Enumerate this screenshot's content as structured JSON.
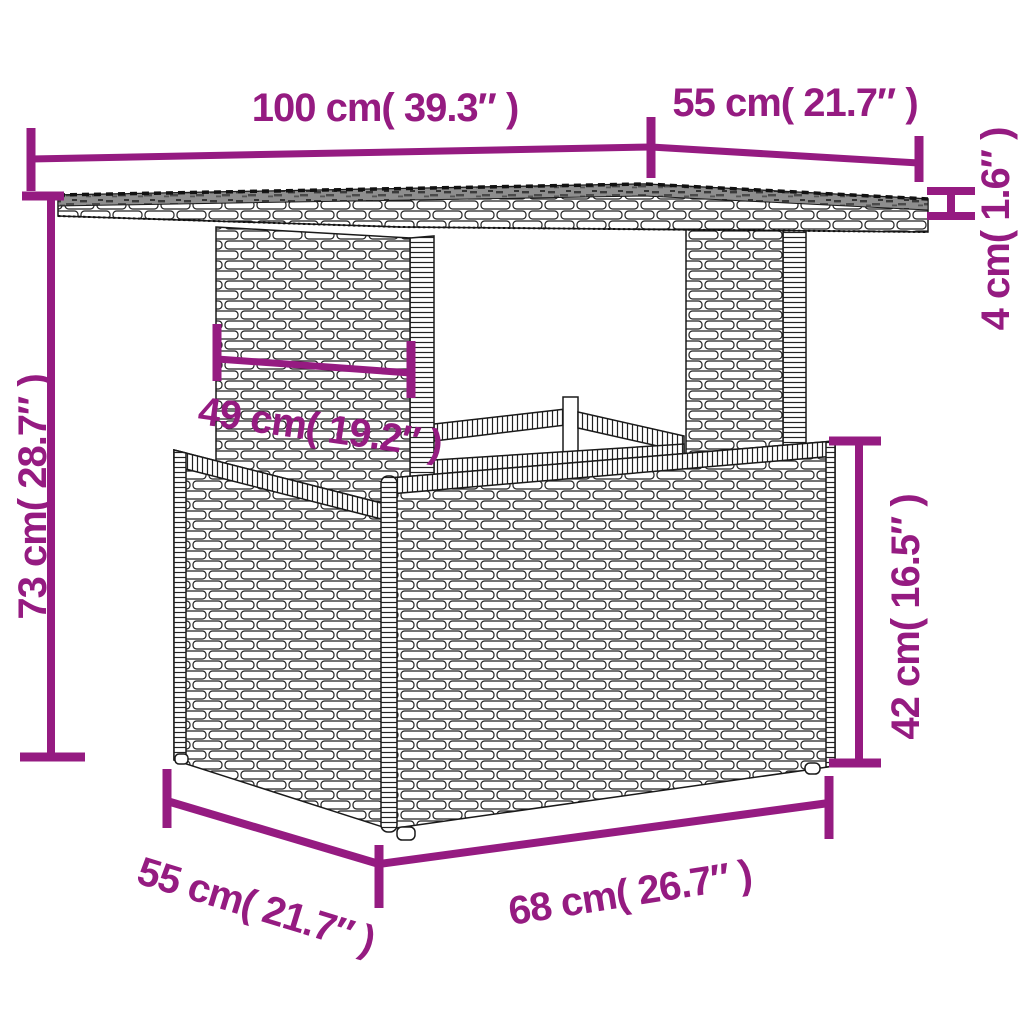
{
  "diagram": {
    "type": "product-dimension-diagram",
    "subject": "poly rattan garden table with glass top and storage base",
    "accent_color": "#951b81",
    "labels": {
      "top_width": "100 cm( 39.3″ )",
      "top_depth": "55 cm( 21.7″ )",
      "top_thickness": "4 cm( 1.6″ )",
      "overall_height": "73 cm( 28.7″ )",
      "leg_panel_width": "49 cm( 19.2″ )",
      "base_height": "42 cm( 16.5″ )",
      "base_depth": "55 cm( 21.7″ )",
      "base_width": "68 cm( 26.7″ )"
    }
  }
}
